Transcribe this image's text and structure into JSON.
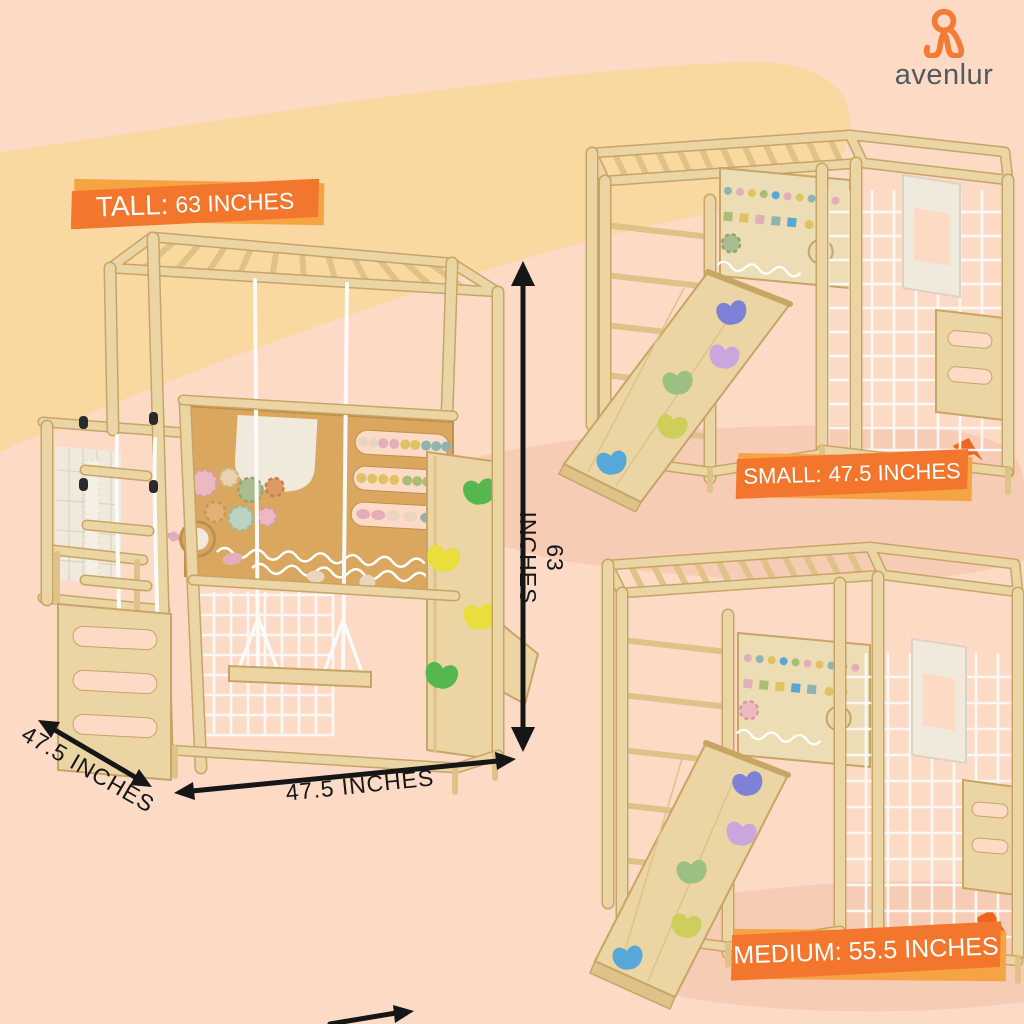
{
  "brand": {
    "name": "avenlur"
  },
  "banners": {
    "tall": {
      "prefix": "TALL:",
      "value": "63 INCHES"
    },
    "small": {
      "prefix": "SMALL:",
      "value": "47.5 INCHES"
    },
    "medium": {
      "prefix": "MEDIUM:",
      "value": "55.5 INCHES"
    }
  },
  "dimensions": {
    "height": "63 INCHES",
    "width": "47.5 INCHES",
    "depth": "47.5 INCHES"
  },
  "colors": {
    "bg_base": "#FCDAC6",
    "bg_band": "#FBD7A2",
    "bg_brush": "#F8CBB4",
    "banner_orange": "#F4762D",
    "banner_accent": "#F6A344",
    "banner_fold": "#EC661C",
    "text_dark": "#161616",
    "white": "#FFFFFF",
    "logo_orange": "#F37B36",
    "logo_text": "#54595E",
    "wood_light": "#EBD5A4",
    "wood_shade": "#DFC288",
    "wood_edge": "#C8A465",
    "wood_mid": "#D9A75F",
    "wood_mid_edge": "#C08F4B",
    "wood_panel": "#EDDDB4",
    "cream": "#F1EADC",
    "net_white": "#FBFAF7",
    "hold_green": "#55B84F",
    "hold_yellow": "#E9DE3D",
    "ramp_purple": "#7E82D6",
    "ramp_lavender": "#C9A6DE",
    "ramp_green": "#9CC07F",
    "ramp_yellow": "#CCD05A",
    "ramp_blue": "#55A8D8",
    "bead_cream": "#EAD5C0",
    "bead_pink": "#E3AEB9",
    "bead_yellow": "#DFC263",
    "bead_teal": "#8FB3AE",
    "flower_green": "#A9BD74"
  }
}
